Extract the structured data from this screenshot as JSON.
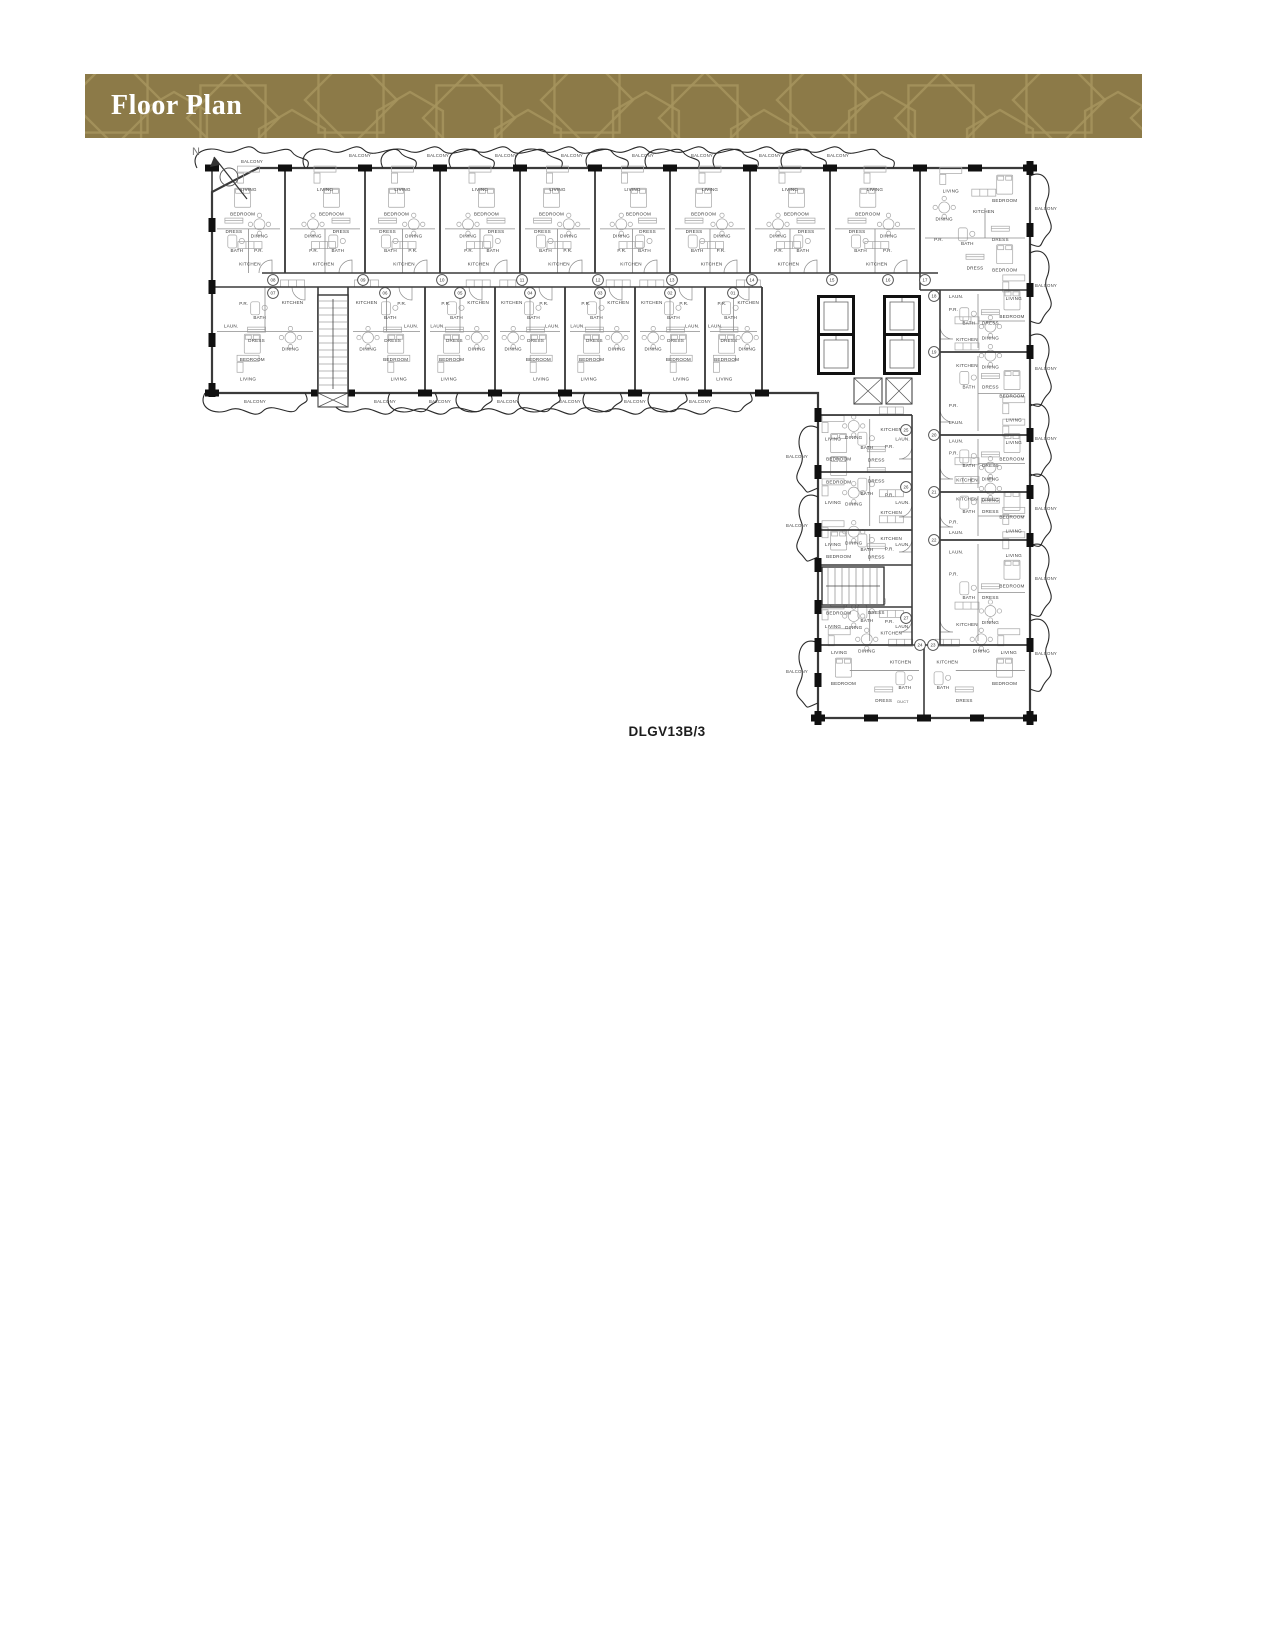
{
  "header": {
    "title": "Floor Plan",
    "bg": "#8c7a48",
    "pattern_color": "#a6945e",
    "text_color": "#ffffff"
  },
  "plan": {
    "caption": "DLGV13B/3",
    "north_label": "N",
    "balcony_label": "BALCONY",
    "colors": {
      "wall": "#3a3a3a",
      "outer": "#3a3a3a",
      "pier": "#101010",
      "partition": "#8c8c8c",
      "furniture": "#a5a5a5",
      "label": "#3c3c3c",
      "cloud": "#2a2a2a",
      "circle": "#4a4a4a"
    },
    "outline": [
      [
        258,
        168
      ],
      [
        1030,
        168
      ],
      [
        1030,
        718
      ],
      [
        818,
        718
      ],
      [
        818,
        393
      ],
      [
        212,
        393
      ],
      [
        212,
        192
      ]
    ],
    "corridors": [
      [
        262,
        273,
        938,
        273
      ],
      [
        212,
        287,
        762,
        287
      ],
      [
        762,
        287,
        762,
        393
      ],
      [
        940,
        290,
        940,
        645
      ],
      [
        912,
        415,
        912,
        645
      ],
      [
        818,
        415,
        912,
        415
      ]
    ],
    "extra_walls": [
      [
        920,
        168,
        920,
        290
      ],
      [
        920,
        290,
        940,
        290
      ],
      [
        818,
        645,
        1030,
        645
      ],
      [
        924,
        645,
        924,
        718
      ]
    ],
    "wings": {
      "top_row": {
        "y": 168,
        "h": 105,
        "units": [
          [
            212,
            285
          ],
          [
            285,
            365
          ],
          [
            365,
            440
          ],
          [
            440,
            520
          ],
          [
            520,
            595
          ],
          [
            595,
            670
          ],
          [
            670,
            750
          ],
          [
            750,
            830
          ],
          [
            830,
            920
          ]
        ]
      },
      "bottom_row": {
        "y": 287,
        "h": 106,
        "units": [
          [
            212,
            318
          ],
          [
            348,
            425
          ],
          [
            425,
            495
          ],
          [
            495,
            565
          ],
          [
            565,
            635
          ],
          [
            635,
            705
          ],
          [
            705,
            762
          ]
        ]
      },
      "right_col": {
        "x": 940,
        "w": 90,
        "units": [
          [
            290,
            352
          ],
          [
            352,
            435
          ],
          [
            435,
            492
          ],
          [
            492,
            540
          ],
          [
            540,
            645
          ]
        ]
      },
      "left_col": {
        "x": 818,
        "w": 94,
        "units": [
          [
            415,
            472
          ],
          [
            472,
            530
          ],
          [
            530,
            565
          ],
          [
            607,
            645
          ]
        ]
      },
      "bottom_pair": {
        "y": 645,
        "h": 73,
        "units": [
          [
            818,
            924
          ],
          [
            924,
            1030
          ]
        ]
      },
      "corner": {
        "x": 920,
        "y": 168,
        "w": 110,
        "h": 122
      }
    },
    "room_templates": {
      "top_row": [
        [
          "LIVING",
          0.5,
          0.22
        ],
        [
          "BEDROOM",
          0.42,
          0.45
        ],
        [
          "DRESS",
          0.3,
          0.62
        ],
        [
          "DINING",
          0.65,
          0.66
        ],
        [
          "BATH",
          0.34,
          0.8
        ],
        [
          "P.R.",
          0.64,
          0.8
        ],
        [
          "KITCHEN",
          0.52,
          0.93
        ]
      ],
      "bottom_row": [
        [
          "P.R.",
          0.3,
          0.17
        ],
        [
          "KITCHEN",
          0.76,
          0.16
        ],
        [
          "BATH",
          0.45,
          0.3
        ],
        [
          "LAUN.",
          0.18,
          0.38
        ],
        [
          "DRESS",
          0.42,
          0.52
        ],
        [
          "DINING",
          0.74,
          0.6
        ],
        [
          "BEDROOM",
          0.38,
          0.7
        ],
        [
          "LIVING",
          0.34,
          0.88
        ]
      ],
      "right_col": [
        [
          "LAUN.",
          0.18,
          0.13
        ],
        [
          "P.R.",
          0.15,
          0.34
        ],
        [
          "BATH",
          0.32,
          0.56
        ],
        [
          "DRESS",
          0.56,
          0.56
        ],
        [
          "KITCHEN",
          0.3,
          0.82
        ],
        [
          "DINING",
          0.56,
          0.8
        ],
        [
          "BEDROOM",
          0.8,
          0.45
        ],
        [
          "LIVING",
          0.82,
          0.16
        ]
      ],
      "left_col": [
        [
          "KITCHEN",
          0.78,
          0.28
        ],
        [
          "P.R.",
          0.76,
          0.58
        ],
        [
          "BATH",
          0.52,
          0.6
        ],
        [
          "LAUN.",
          0.9,
          0.45
        ],
        [
          "DINING",
          0.38,
          0.42
        ],
        [
          "LIVING",
          0.16,
          0.45
        ],
        [
          "BEDROOM",
          0.22,
          0.8
        ],
        [
          "DRESS",
          0.62,
          0.82
        ]
      ],
      "bottom_pair": [
        [
          "LIVING",
          0.2,
          0.12
        ],
        [
          "DINING",
          0.46,
          0.1
        ],
        [
          "KITCHEN",
          0.78,
          0.25
        ],
        [
          "BEDROOM",
          0.24,
          0.55
        ],
        [
          "BATH",
          0.82,
          0.6
        ],
        [
          "DRESS",
          0.62,
          0.78
        ]
      ],
      "corner": [
        [
          "LIVING",
          0.28,
          0.2
        ],
        [
          "DINING",
          0.22,
          0.43
        ],
        [
          "KITCHEN",
          0.58,
          0.37
        ],
        [
          "BEDROOM",
          0.77,
          0.28
        ],
        [
          "P.R.",
          0.17,
          0.6
        ],
        [
          "BATH",
          0.43,
          0.63
        ],
        [
          "DRESS",
          0.73,
          0.6
        ],
        [
          "BEDROOM",
          0.77,
          0.85
        ],
        [
          "DRESS",
          0.5,
          0.83
        ]
      ]
    },
    "circles": [
      [
        "08",
        273,
        280
      ],
      [
        "09",
        363,
        280
      ],
      [
        "10",
        442,
        280
      ],
      [
        "11",
        522,
        280
      ],
      [
        "12",
        598,
        280
      ],
      [
        "13",
        672,
        280
      ],
      [
        "14",
        752,
        280
      ],
      [
        "15",
        832,
        280
      ],
      [
        "16",
        888,
        280
      ],
      [
        "17",
        925,
        280
      ],
      [
        "07",
        273,
        293
      ],
      [
        "06",
        385,
        293
      ],
      [
        "05",
        460,
        293
      ],
      [
        "04",
        530,
        293
      ],
      [
        "03",
        600,
        293
      ],
      [
        "02",
        670,
        293
      ],
      [
        "01",
        733,
        293
      ],
      [
        "18",
        934,
        296
      ],
      [
        "19",
        934,
        352
      ],
      [
        "20",
        934,
        435
      ],
      [
        "21",
        934,
        492
      ],
      [
        "22",
        934,
        540
      ],
      [
        "25",
        906,
        430
      ],
      [
        "26",
        906,
        487
      ],
      [
        "27",
        906,
        618
      ],
      [
        "24",
        920,
        645
      ],
      [
        "23",
        933,
        645
      ]
    ],
    "balconies": {
      "top": [
        [
          252,
          163
        ],
        [
          360,
          157
        ],
        [
          438,
          157
        ],
        [
          506,
          157
        ],
        [
          572,
          157
        ],
        [
          643,
          157
        ],
        [
          702,
          157
        ],
        [
          770,
          157
        ],
        [
          838,
          157
        ]
      ],
      "bottom": [
        [
          255,
          403
        ],
        [
          385,
          403
        ],
        [
          440,
          403
        ],
        [
          508,
          403
        ],
        [
          570,
          403
        ],
        [
          635,
          403
        ],
        [
          700,
          403
        ]
      ],
      "right": [
        [
          1046,
          210
        ],
        [
          1046,
          287
        ],
        [
          1046,
          370
        ],
        [
          1046,
          440
        ],
        [
          1046,
          510
        ],
        [
          1046,
          580
        ],
        [
          1046,
          655
        ]
      ],
      "left": [
        [
          797,
          458
        ],
        [
          797,
          527
        ],
        [
          797,
          673
        ]
      ]
    },
    "special_labels": [
      [
        "DUCT",
        903,
        703
      ]
    ],
    "cores": {
      "elevators": [
        [
          820,
          298,
          32,
          36
        ],
        [
          820,
          336,
          32,
          36
        ],
        [
          886,
          298,
          32,
          36
        ],
        [
          886,
          336,
          32,
          36
        ]
      ],
      "shafts": [
        [
          854,
          378,
          28,
          26
        ],
        [
          886,
          378,
          26,
          26
        ],
        [
          318,
          393,
          30,
          14
        ]
      ]
    },
    "stairs": [
      [
        318,
        295,
        30,
        98,
        "v"
      ],
      [
        822,
        567,
        62,
        38,
        "h"
      ]
    ],
    "north_arrow": {
      "x": 229,
      "y": 177,
      "label_x": 196,
      "label_y": 155
    }
  }
}
